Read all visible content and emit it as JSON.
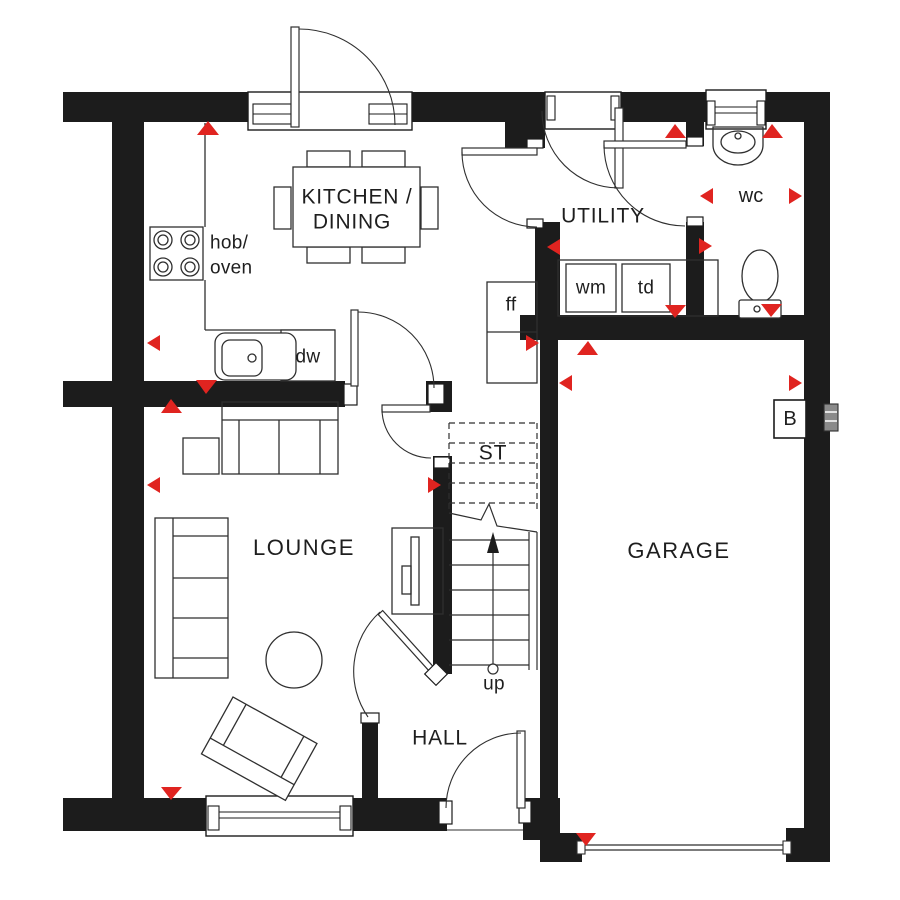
{
  "plan_title": "Ground floor plan",
  "rooms": {
    "kitchen_dining_line1": "KITCHEN /",
    "kitchen_dining_line2": "DINING",
    "utility": "UTILITY",
    "wc": "wc",
    "garage": "GARAGE",
    "store": "ST",
    "lounge": "LOUNGE",
    "hall": "HALL"
  },
  "appliances": {
    "hob_line1": "hob/",
    "hob_line2": "oven",
    "dishwasher": "dw",
    "fridge_freezer": "ff",
    "washing_machine": "wm",
    "tumble_dryer": "td",
    "boiler": "B"
  },
  "stairs": {
    "up_label": "up"
  },
  "colors": {
    "wall": "#1c1c1c",
    "marker_red": "#e02420",
    "line": "#2f2f2f"
  }
}
